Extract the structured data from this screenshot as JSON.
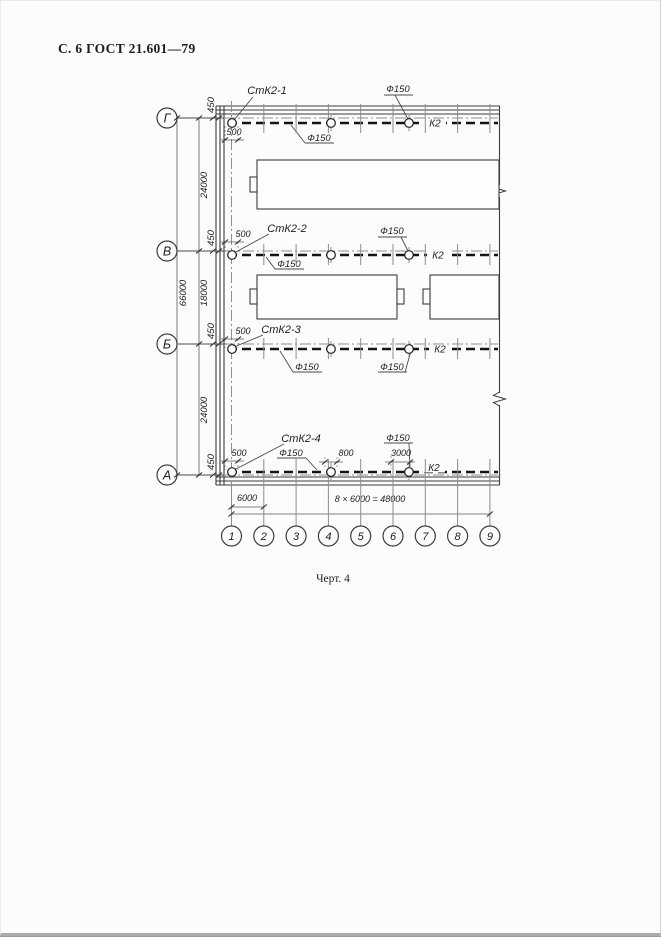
{
  "page": {
    "header": "С. 6 ГОСТ 21.601—79",
    "caption": "Черт. 4"
  },
  "drawing": {
    "row_axes": [
      {
        "label": "Г"
      },
      {
        "label": "В"
      },
      {
        "label": "Б"
      },
      {
        "label": "А"
      }
    ],
    "col_axes": [
      "1",
      "2",
      "3",
      "4",
      "5",
      "6",
      "7",
      "8",
      "9"
    ],
    "risers": [
      {
        "label": "СтК2-1"
      },
      {
        "label": "СтК2-2"
      },
      {
        "label": "СтК2-3"
      },
      {
        "label": "СтК2-4"
      }
    ],
    "pipe_label": "К2",
    "diameter_label": "Ф150",
    "dims": {
      "axis_offset": "450",
      "riser_offset": "500",
      "span_g_v": "24000",
      "span_v_b": "18000",
      "span_b_a": "24000",
      "total_height": "66000",
      "first_bay": "6000",
      "bay_formula": "8 × 6000 = 48000",
      "offset_800": "800",
      "offset_3000": "3000"
    }
  }
}
